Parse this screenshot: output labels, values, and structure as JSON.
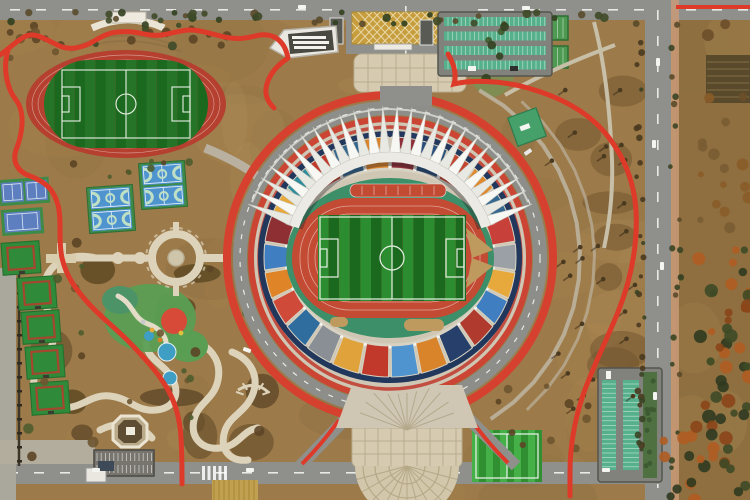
{
  "scene": {
    "kind": "aerial-photo",
    "subject": "sports-complex-with-stadium",
    "facilities": [
      "main-stadium",
      "practice-track-field",
      "tennis-courts",
      "basketball-courts",
      "gateball-courts",
      "children-playground",
      "central-plaza",
      "north-entrance-plaza",
      "south-entrance-plaza",
      "northeast-parking-lot",
      "southeast-parking-lot",
      "five-a-side-field",
      "jogging-path",
      "perimeter-roads"
    ]
  },
  "palette": {
    "ground": "#9c7a49",
    "ground_light": "#b3905c",
    "ground_dark": "#85653a",
    "road": "#8f8f8b",
    "road_light": "#aaa79d",
    "sidewalk_pink": "#c99a78",
    "red_path": "#dd3a2a",
    "track_red": "#c34a33",
    "practice_track_red": "#b5402f",
    "pitch_green": "#1f7a24",
    "pitch_green_dark": "#1a691f",
    "pitch_green_light": "#2b8c30",
    "teal_surround": "#3c8f68",
    "concourse": "#cfc7b4",
    "navy_rim": "#22375c",
    "roof_white": "#f7f7f3",
    "roof_band": "#eceae4",
    "roof_edge": "#c9c9c0",
    "court_blue": "#4f94cf",
    "court_blue_light": "#6aa8dc",
    "court_green": "#3e8a48",
    "gateball_green": "#2f8a3a",
    "gateball_line": "#a5472e",
    "plaza_tan": "#d6cbb0",
    "plaza_grid": "#b9ad90",
    "hatch_yellow": "#c79d3e",
    "hatch_line": "#e8d9a8",
    "water_blue": "#3f9ec4",
    "play_red": "#d84a38",
    "play_green": "#5a9e53",
    "lawn_green": "#7c8f54",
    "stall_green": "#57b08c",
    "hedge_green": "#4f7040",
    "asphalt": "#82827c",
    "autumn_orange": "#b05c22",
    "autumn_rust": "#8a4518",
    "tree_dark": "#4a3a20",
    "tree_green": "#3f4a28",
    "shrub_brown": "#5c4526",
    "path_cream": "#ddd3ba",
    "white": "#f2f0e8",
    "sand_tan": "#bf9a5e",
    "building_white": "#e9e7e0",
    "building_dark": "#4a4a42"
  },
  "stadium": {
    "center_x": 390,
    "center_y": 258,
    "ring_road_radius": 163,
    "seat_colors": [
      "#8f3038",
      "#2a4f7c",
      "#c2452f",
      "#e0892c",
      "#35688f",
      "#c8403a",
      "#9aa0a6",
      "#e8a93c",
      "#3f7fc1",
      "#b03a2e",
      "#27406b",
      "#d9832b",
      "#4f94cf",
      "#c0392b",
      "#e0a33c",
      "#8a8f96",
      "#2e6d9e",
      "#d04a3a",
      "#e08428",
      "#3f7fc1",
      "#8e2f33",
      "#e8a93c",
      "#2e8b9b",
      "#c0392b",
      "#35688f",
      "#d9832b"
    ],
    "roof": {
      "pleats": 26,
      "angle_start": 198,
      "angle_end": 342,
      "outer_r": 152,
      "inner_r": 106
    }
  }
}
